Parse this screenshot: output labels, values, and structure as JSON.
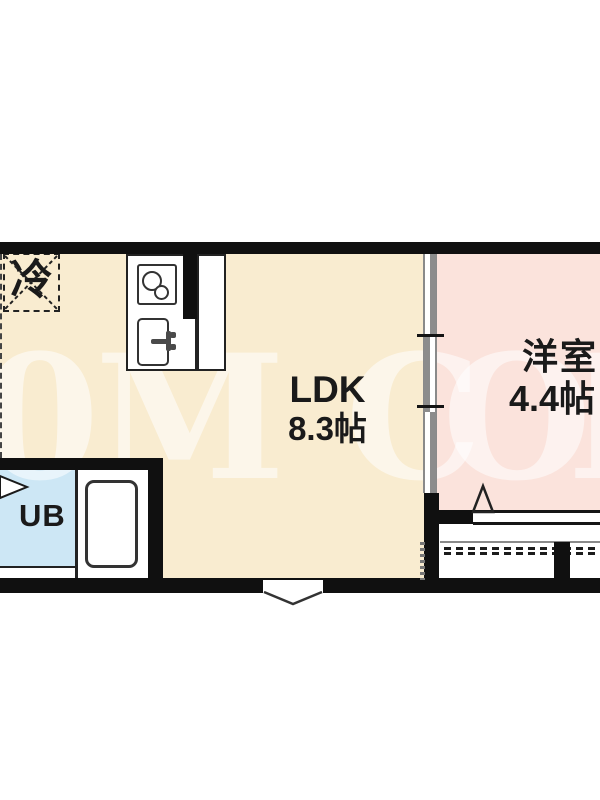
{
  "floor_plan": {
    "rooms": {
      "ldk": {
        "label": "LDK",
        "size": "8.3帖",
        "floor_color": "#f9ecd0"
      },
      "western_room": {
        "label": "洋室",
        "size": "4.4帖",
        "floor_color": "#fbe3dc"
      },
      "unit_bath": {
        "label": "UB",
        "floor_color": "#cde7f5"
      },
      "refrigerator": {
        "label": "冷"
      }
    },
    "watermark": {
      "letters": [
        "0",
        "M",
        "C",
        "O",
        "M"
      ],
      "color": "rgba(255,255,255,0.55)"
    },
    "wall_color": "#101010"
  }
}
